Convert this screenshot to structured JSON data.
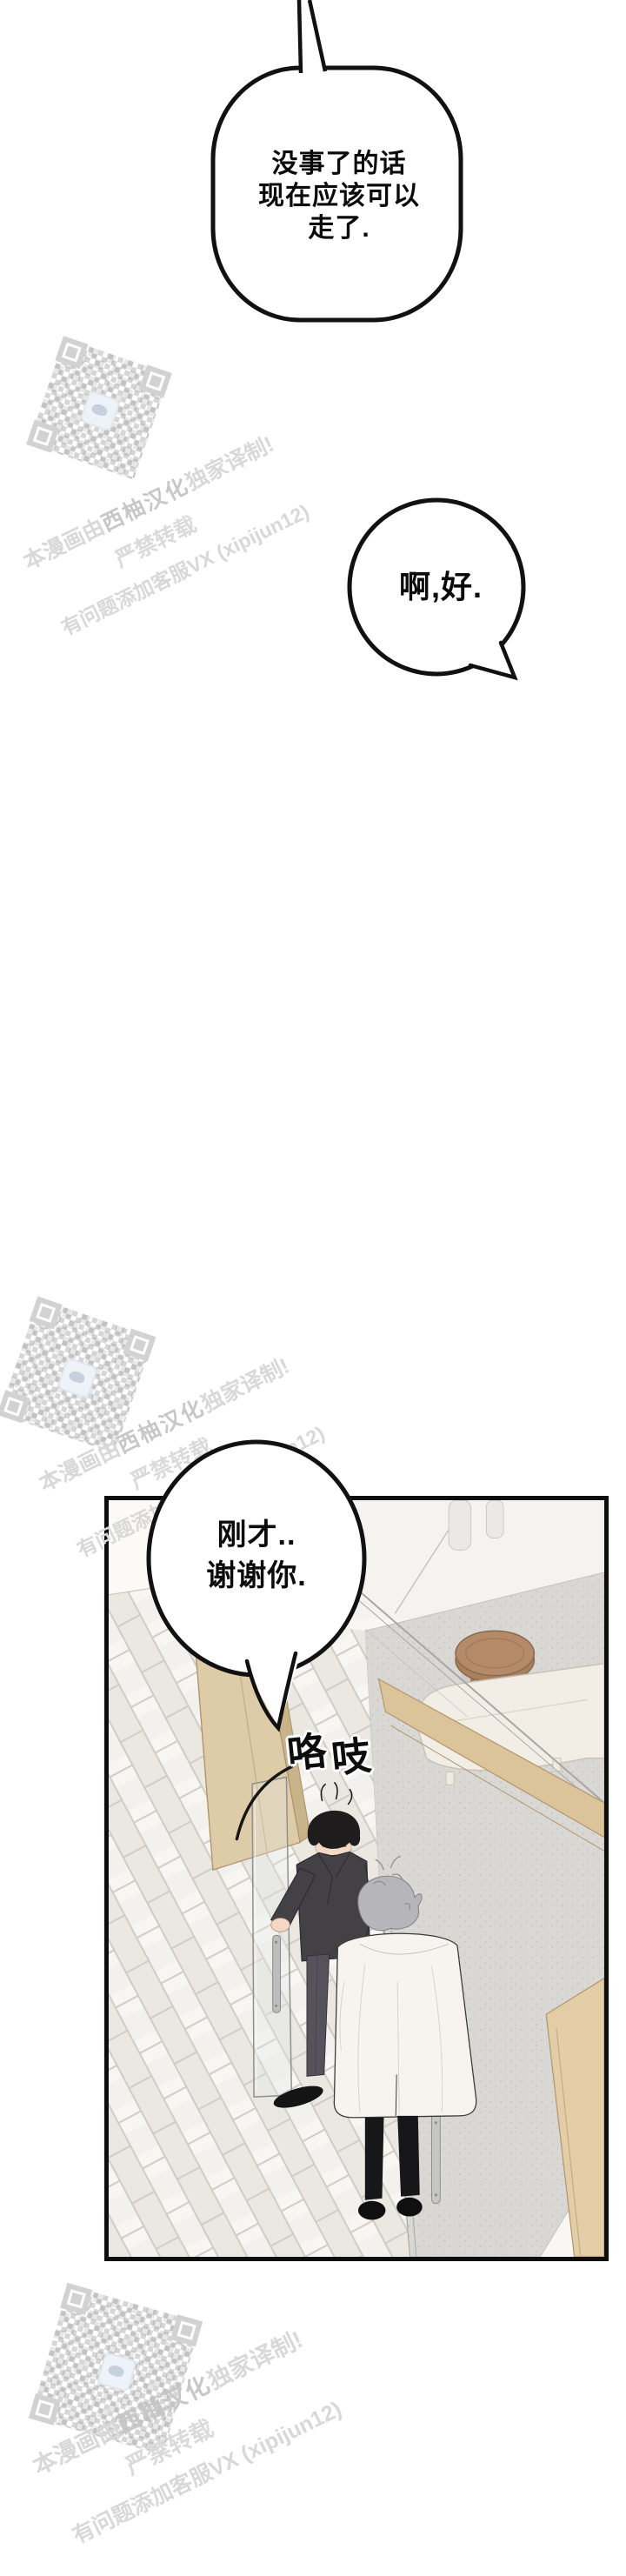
{
  "comic": {
    "bubble1": {
      "lines": [
        "没事了的话",
        "现在应该可以",
        "走了."
      ]
    },
    "bubble2": {
      "text": "啊,好."
    },
    "bubble3": {
      "lines": [
        "刚才..",
        "谢谢你."
      ]
    },
    "sfx": {
      "char1": "咯",
      "char2": "吱"
    }
  },
  "watermark": {
    "line1_prefix": "本漫画由",
    "line1_bold": "西柚汉化",
    "line1_suffix": "独家译制!",
    "line2": "严禁转载",
    "line3": "有问题添加客服VX (xipijun12)"
  },
  "colors": {
    "bubble_border": "#111111",
    "watermark_gray": "#d7d7d7",
    "wood_door": "#decca9",
    "wood_frame": "#dcc49a",
    "suit_dark": "#434146",
    "coat_white": "#f7f3ee",
    "stool_brown": "#b48a69",
    "rug_gray": "#d9d8d4"
  }
}
